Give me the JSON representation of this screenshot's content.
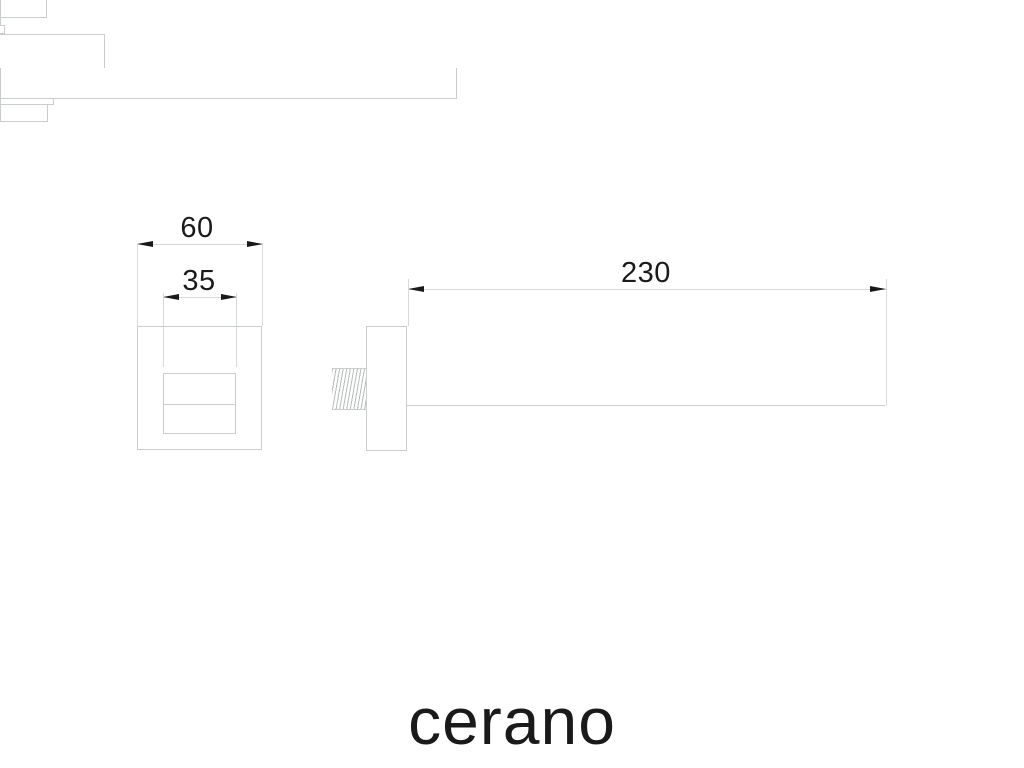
{
  "colors": {
    "background": "#ffffff",
    "line": "#c9cdcd",
    "dimension_line": "#d6d9d9",
    "text": "#1a1a1a",
    "thread": "#b7bbbb"
  },
  "brand": {
    "logo_text": "cerano"
  },
  "views": {
    "front": {
      "dimensions": {
        "flange_width": {
          "value": "60"
        },
        "spout_width": {
          "value": "35"
        }
      }
    },
    "side": {
      "dimensions": {
        "spout_length": {
          "value": "230"
        }
      }
    }
  }
}
